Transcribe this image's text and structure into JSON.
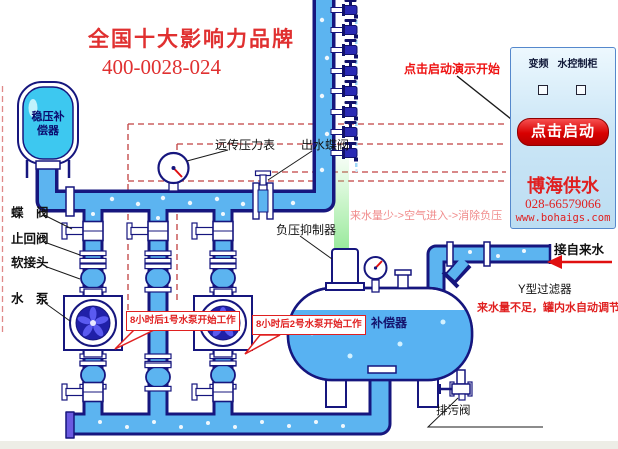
{
  "header": {
    "brand": "全国十大影响力品牌",
    "phone": "400-0028-024"
  },
  "hint": {
    "demo_start": "点击启动演示开始"
  },
  "panel": {
    "title_left": "变频",
    "title_right": "水控制柜",
    "start_button": "点击启动",
    "company": "博海供水",
    "phone": "028-66579066",
    "website": "www.bohaigs.com"
  },
  "labels": {
    "stabilizer_line1": "稳压补",
    "stabilizer_line2": "偿器",
    "butterfly_valve": "蝶　阀",
    "check_valve": "止回阀",
    "soft_joint": "软接头",
    "pump": "水　泵",
    "remote_gauge": "远传压力表",
    "outlet_valve": "出水蝶阀",
    "vacuum_suppressor": "负压抑制器",
    "compensator": "补偿器",
    "tap_water": "接自来水",
    "y_filter": "Y型过滤器",
    "drain_valve": "排污阀"
  },
  "notes": {
    "vacuum": "来水量少->空气进入->消除负压",
    "low_water": "来水量不足，罐内水自动调节",
    "callout_pump1": "8小时后1号水泵开始工作",
    "callout_pump2": "8小时后2号水泵开始工作"
  },
  "colors": {
    "pipe": "#5CB4F0",
    "outline": "#16167E",
    "tank_fill": "#3DC8F0",
    "accent_red": "#E02020",
    "dash_red": "#C04040",
    "note_pink": "#F08C8C",
    "panel_border": "#5588CC",
    "air_green": "#8CE08C"
  }
}
